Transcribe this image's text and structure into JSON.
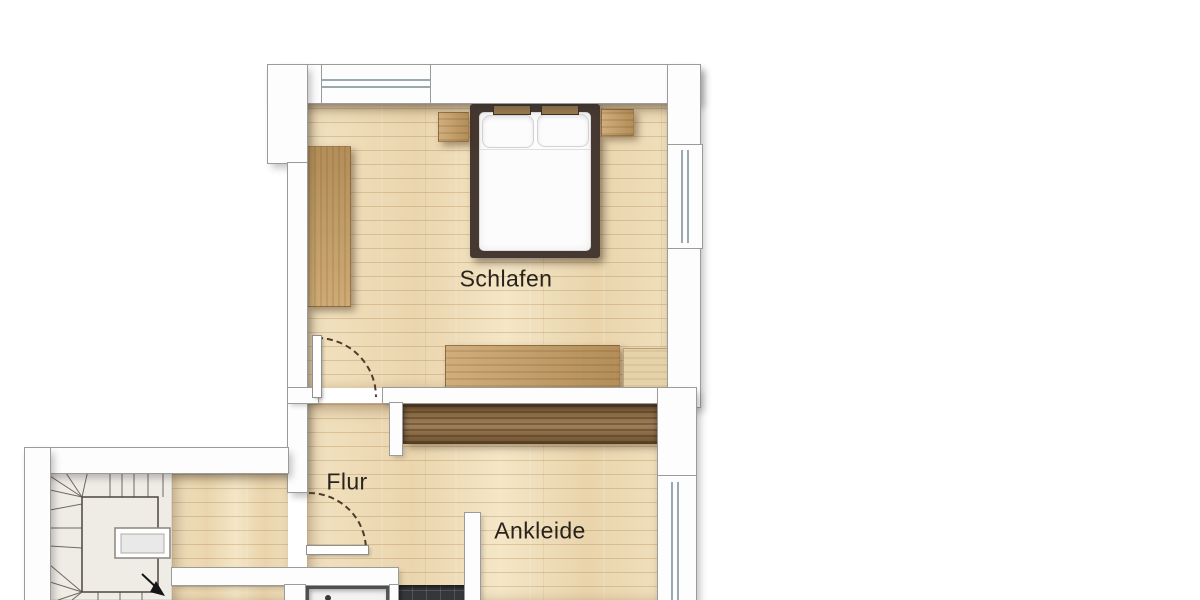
{
  "plan": {
    "rooms": [
      {
        "name": "Schlafen"
      },
      {
        "name": "Flur"
      },
      {
        "name": "Ankleide"
      }
    ]
  },
  "elements": {
    "double_bed": "bed with two pillows and duvet",
    "nightstands": "two bedside tables",
    "bedroom_wardrobe": "tall wardrobe on left wall",
    "sideboard": "low dresser at foot of bedroom",
    "chest": "light chest in bedroom corner",
    "dressing_wardrobe": "dark closet unit along top wall of Ankleide",
    "winder_staircase": "quarter-turn winder stairs with stairwell and chimney block",
    "stair_direction_arrow": "black walk-line arrow",
    "door_swings": "dashed quarter-circle door arcs",
    "shower": "shower tray with drain",
    "dark_tiles": "dark tiled bathroom floor strip",
    "windows": "double-line glazing symbols on top, right and left walls"
  },
  "colors": {
    "wall_fill": "#fdfdfd",
    "wall_line": "#9b9b9b",
    "floor_base": "#eedcb8",
    "tan": "#c79e62",
    "dark_wood": "#8f6a3e",
    "bed_frame": "#463931",
    "mattress": "#fcfcfc",
    "tile": "#35373a",
    "stair_bg": "#efece6",
    "stair_line": "#6f685e",
    "door_arc": "#4e3b28",
    "glass": "#9aa8b0",
    "label": "#28231d",
    "shower_frame": "#55565a",
    "headboard": "#97794f",
    "chest": "#e6d2a8"
  }
}
